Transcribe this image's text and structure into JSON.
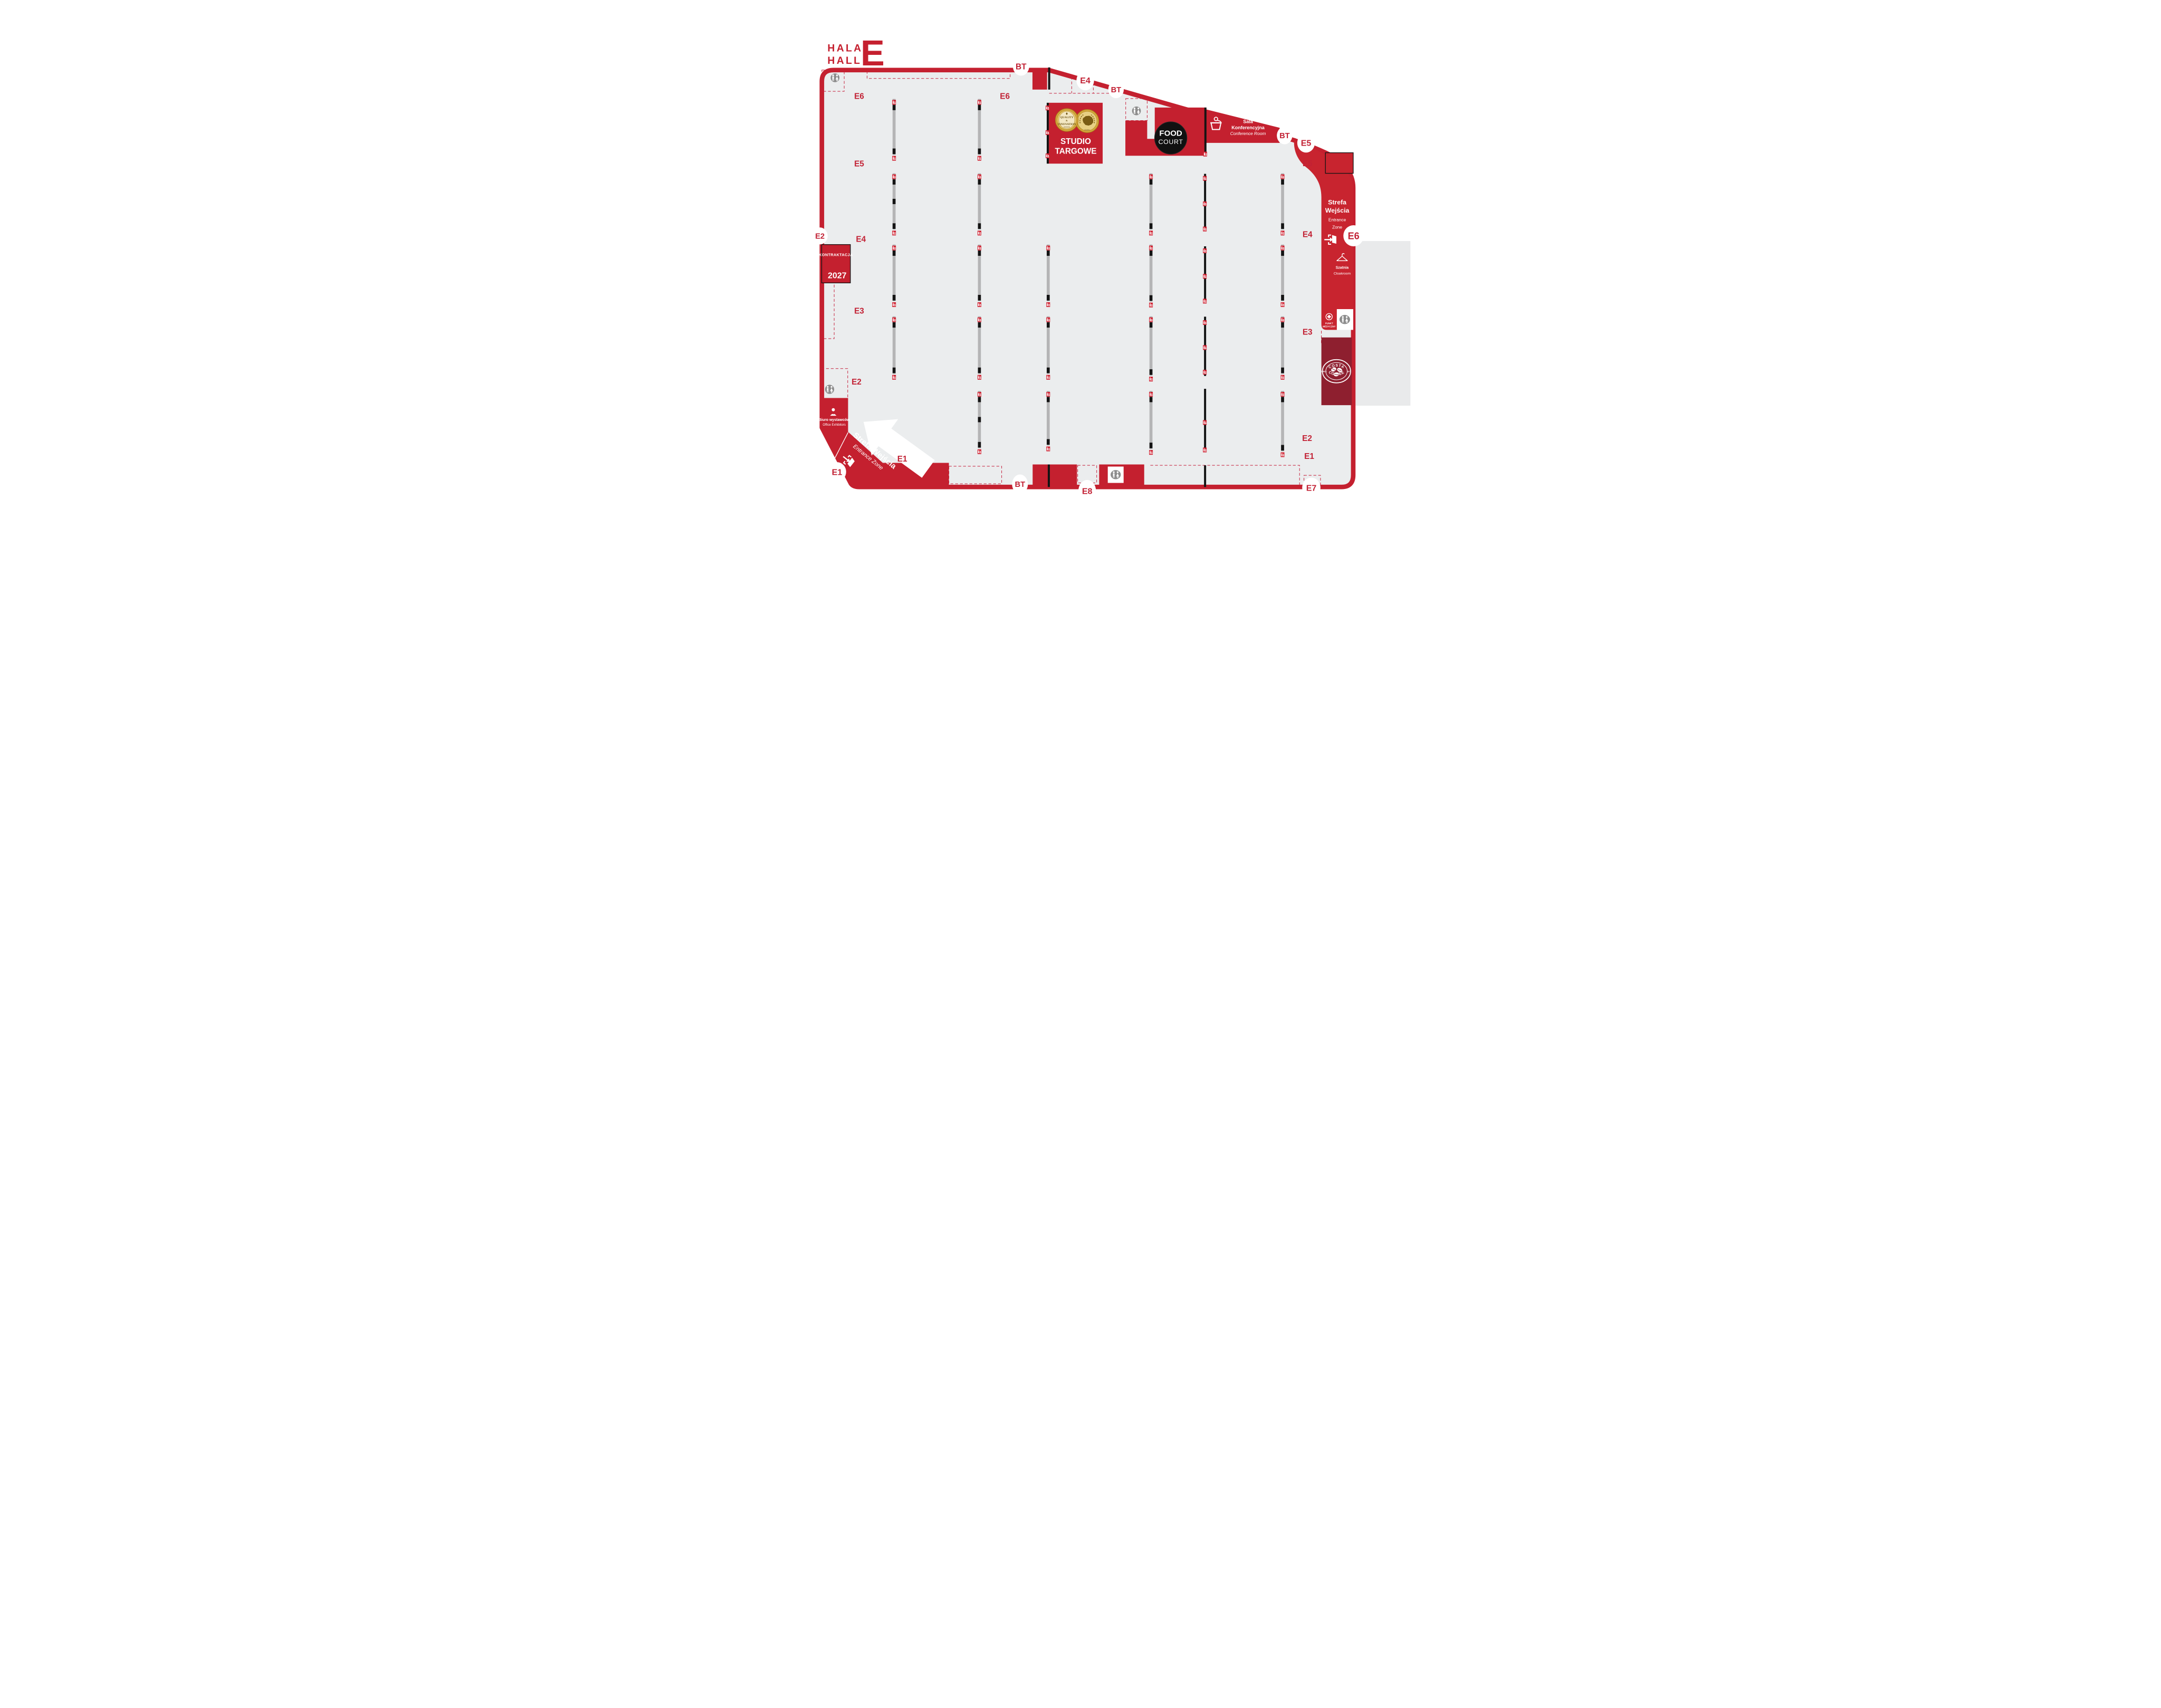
{
  "map_title": {
    "line1": "HALA",
    "line2": "HALL",
    "hall_letter": "E"
  },
  "gates": {
    "bt_top": "BT",
    "e4": "E4",
    "bt_slope": "BT",
    "bt_right": "BT",
    "e5": "E5",
    "e6": "E6",
    "e2": "E2",
    "e1": "E1",
    "bt_bottom": "BT",
    "e8": "E8",
    "e7": "E7"
  },
  "row_labels": {
    "left": [
      "E6",
      "E5",
      "E4",
      "E3",
      "E2",
      "E1"
    ],
    "middle": [
      "E6"
    ],
    "right": [
      "E5",
      "E4",
      "E3",
      "E2",
      "E1"
    ]
  },
  "studio": {
    "line1": "STUDIO",
    "line2": "TARGOWE",
    "medal_left_line1": "QUALITY",
    "medal_left_line2": "&",
    "medal_left_line3": "INNOVATION",
    "medal_right_caption": "EXPO"
  },
  "food_court": {
    "line1": "FOOD",
    "line2": "COURT"
  },
  "conference": {
    "pl1": "Sala",
    "pl2": "Konferencyjna",
    "en": "Conference Room"
  },
  "kontraktacja": {
    "name": "KONTRAKTACJA",
    "year": "2027"
  },
  "entrance_right": {
    "pl1": "Strefa",
    "pl2": "Wejścia",
    "en1": "Entrance",
    "en2": "Zone"
  },
  "entrance_bottom": {
    "pl": "Strefa Wejścia",
    "en": "Entrance Zone"
  },
  "cloakroom": {
    "pl": "Szatnia",
    "en": "Cloakroom"
  },
  "medical_point": {
    "line1": "PUNKT",
    "line2": "MEDYCZNY"
  },
  "exhibitors_office": {
    "pl": "Biuro  wystawców",
    "en": "Office Exhibitors"
  },
  "costa": {
    "arc_top": "COSTA",
    "arc_bottom": "COFFEE",
    "left": "SINCE",
    "right": "1971"
  },
  "colors": {
    "primary_red": "#c4202f",
    "label_red": "#c22134",
    "costa_maroon": "#8e1f2f",
    "floor_gray": "#ebedee",
    "booth_strip_gray": "#b5b5b6",
    "icon_gray": "#8d8d8d",
    "wall_black": "#141414",
    "white": "#ffffff",
    "medal_gold": "#d2a53c"
  },
  "icons": {
    "toilets": "toilets-icon",
    "conference": "lectern-icon",
    "entrance": "door-exit-icon",
    "cloakroom": "hanger-icon",
    "medical": "medical-cross-icon",
    "office": "person-icon",
    "fire": "fire-extinguisher-icon",
    "direction": "direction-arrow"
  }
}
